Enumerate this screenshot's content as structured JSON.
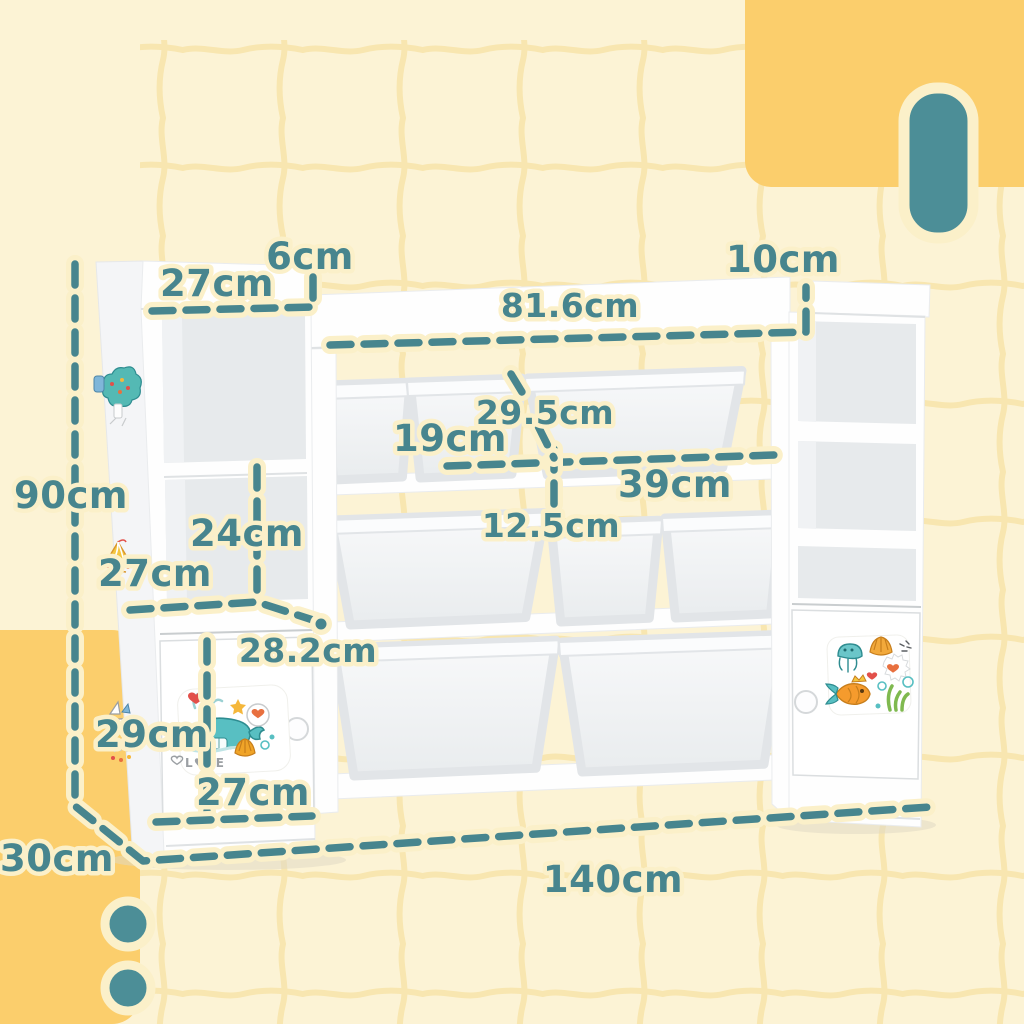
{
  "diagram_type": "product-dimension-diagram",
  "colors": {
    "background_cream": "#FCF3D5",
    "grid_line": "#F8E5AC",
    "block_orange": "#FBCE6C",
    "accent_teal": "#4C8E97",
    "dash_teal": "#47858E",
    "label_outline_cream": "#FBF0C9",
    "furniture_white": "#FEFEFE"
  },
  "dimensions": {
    "total_height": "90cm",
    "total_depth": "30cm",
    "total_width": "140cm",
    "left_top_width": "27cm",
    "left_lip_height": "6cm",
    "middle_top_width": "81.6cm",
    "right_lip_height": "10cm",
    "bin_large_depth": "29.5cm",
    "bin_small_width": "19cm",
    "bin_large_width": "39cm",
    "bin_height": "12.5cm",
    "left_shelf_height": "24cm",
    "left_shelf_width": "27cm",
    "left_shelf_diagonal": "28.2cm",
    "door_height": "29cm",
    "door_width": "27cm"
  },
  "stickers": {
    "whale_love_text": "L♥VE"
  }
}
